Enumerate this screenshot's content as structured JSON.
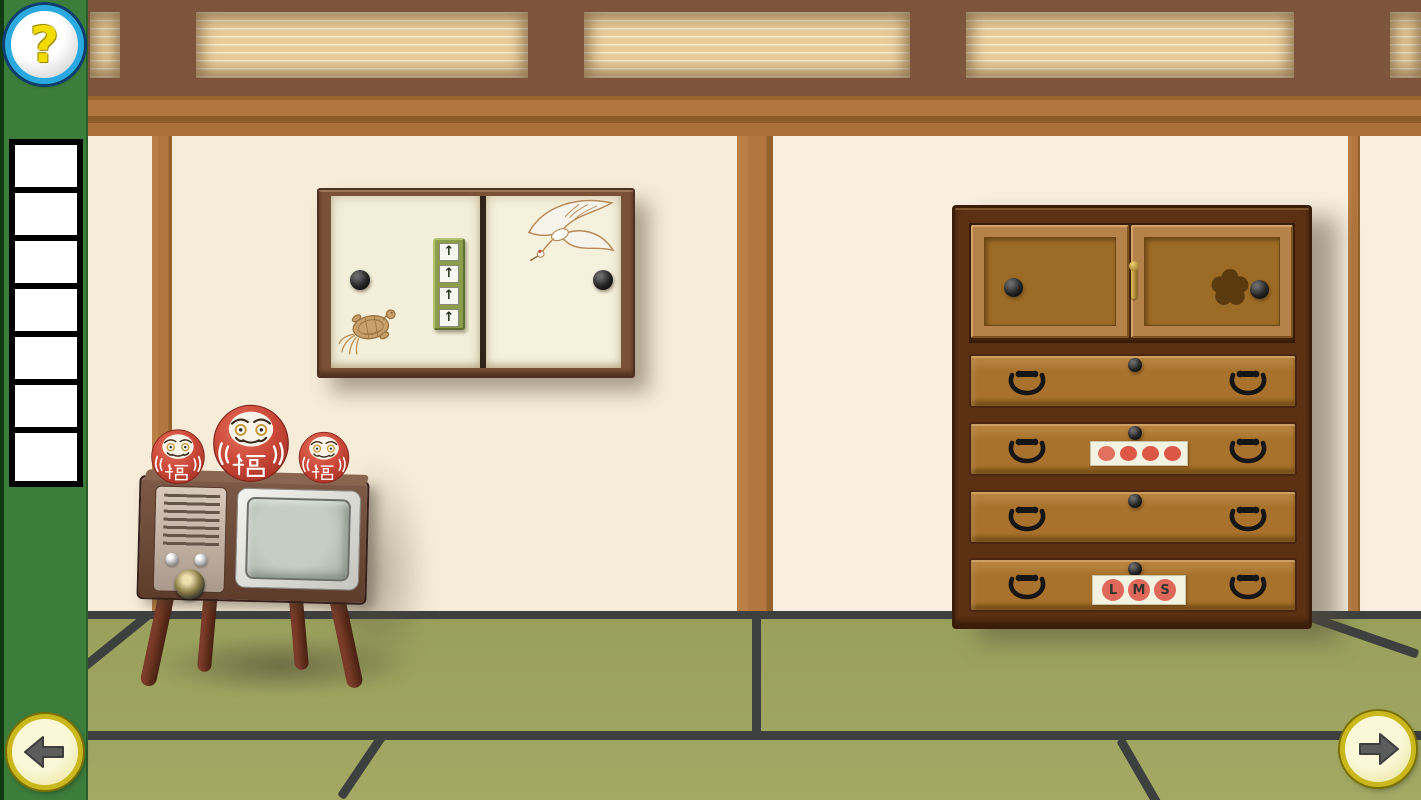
{
  "app": {
    "type": "room-escape-game",
    "scene": "japanese-tatami-room"
  },
  "palette": {
    "sidebar_green": "#3d7d3c",
    "wall_cream": "#f6ecd8",
    "wood_beam": "#b1773e",
    "transom_frame": "#7d553a",
    "transom_panel": "#e8cd9b",
    "tatami": "#9ca15f",
    "tatami_seam": "#3d403f",
    "cabinet_door_cream": "#f3efda",
    "arrow_panel_green": "#8c9e4c",
    "chest_frame_brown": "#5c3113",
    "chest_drawer_brown": "#a8722c",
    "daruma_red": "#c64a3c",
    "dot_red": "#dd5747",
    "lms_circle_red": "#e0685a",
    "help_ring_blue": "#2aa9e0",
    "help_glyph_yellow": "#f2dc00",
    "nav_ring_gold": "#c9b71c"
  },
  "sidebar": {
    "help_button": {
      "glyph": "?",
      "icon": "question-mark-icon"
    },
    "inventory": {
      "slot_count": 7,
      "slots_empty": true
    }
  },
  "navigation": {
    "left": {
      "icon": "arrow-left-icon",
      "direction": "left"
    },
    "right": {
      "icon": "arrow-right-icon",
      "direction": "right"
    }
  },
  "transom": {
    "visible_panel_count": 5,
    "texture": "horizontal-slats"
  },
  "wall_cabinet": {
    "left_door": {
      "motif": "turtle",
      "handle": "black knob"
    },
    "right_door": {
      "motif": "crane",
      "handle": "black knob"
    },
    "arrow_panel": {
      "buttons": [
        "↑",
        "↑",
        "↑",
        "↑"
      ],
      "button_count": 4
    }
  },
  "tv": {
    "style": "vintage wooden television on four legs",
    "screen": "blank green-gray",
    "controls": {
      "small_knobs": 2,
      "large_knobs": 1,
      "speaker_slats": 8
    },
    "darumas": [
      {
        "size": "small",
        "belly_character": "福"
      },
      {
        "size": "large",
        "belly_character": "福"
      },
      {
        "size": "small",
        "belly_character": "福"
      }
    ]
  },
  "chest": {
    "top": {
      "left_door": {
        "handle": "black knob"
      },
      "right_door": {
        "handle": "black knob",
        "cutout": "plum-blossom-hole"
      },
      "latch": "brass pin"
    },
    "drawers": [
      {
        "label": "drawer-1",
        "handles": 2,
        "knob": 1,
        "panel": null
      },
      {
        "label": "drawer-2",
        "handles": 2,
        "knob": 1,
        "panel": {
          "type": "dots",
          "count": 4,
          "dot_colors": [
            "#e2705f",
            "#dd5747",
            "#dd5747",
            "#dd5747"
          ]
        }
      },
      {
        "label": "drawer-3",
        "handles": 2,
        "knob": 1,
        "panel": null
      },
      {
        "label": "drawer-4",
        "handles": 2,
        "knob": 1,
        "panel": {
          "type": "letters",
          "letters": [
            "L",
            "M",
            "S"
          ]
        }
      }
    ]
  }
}
